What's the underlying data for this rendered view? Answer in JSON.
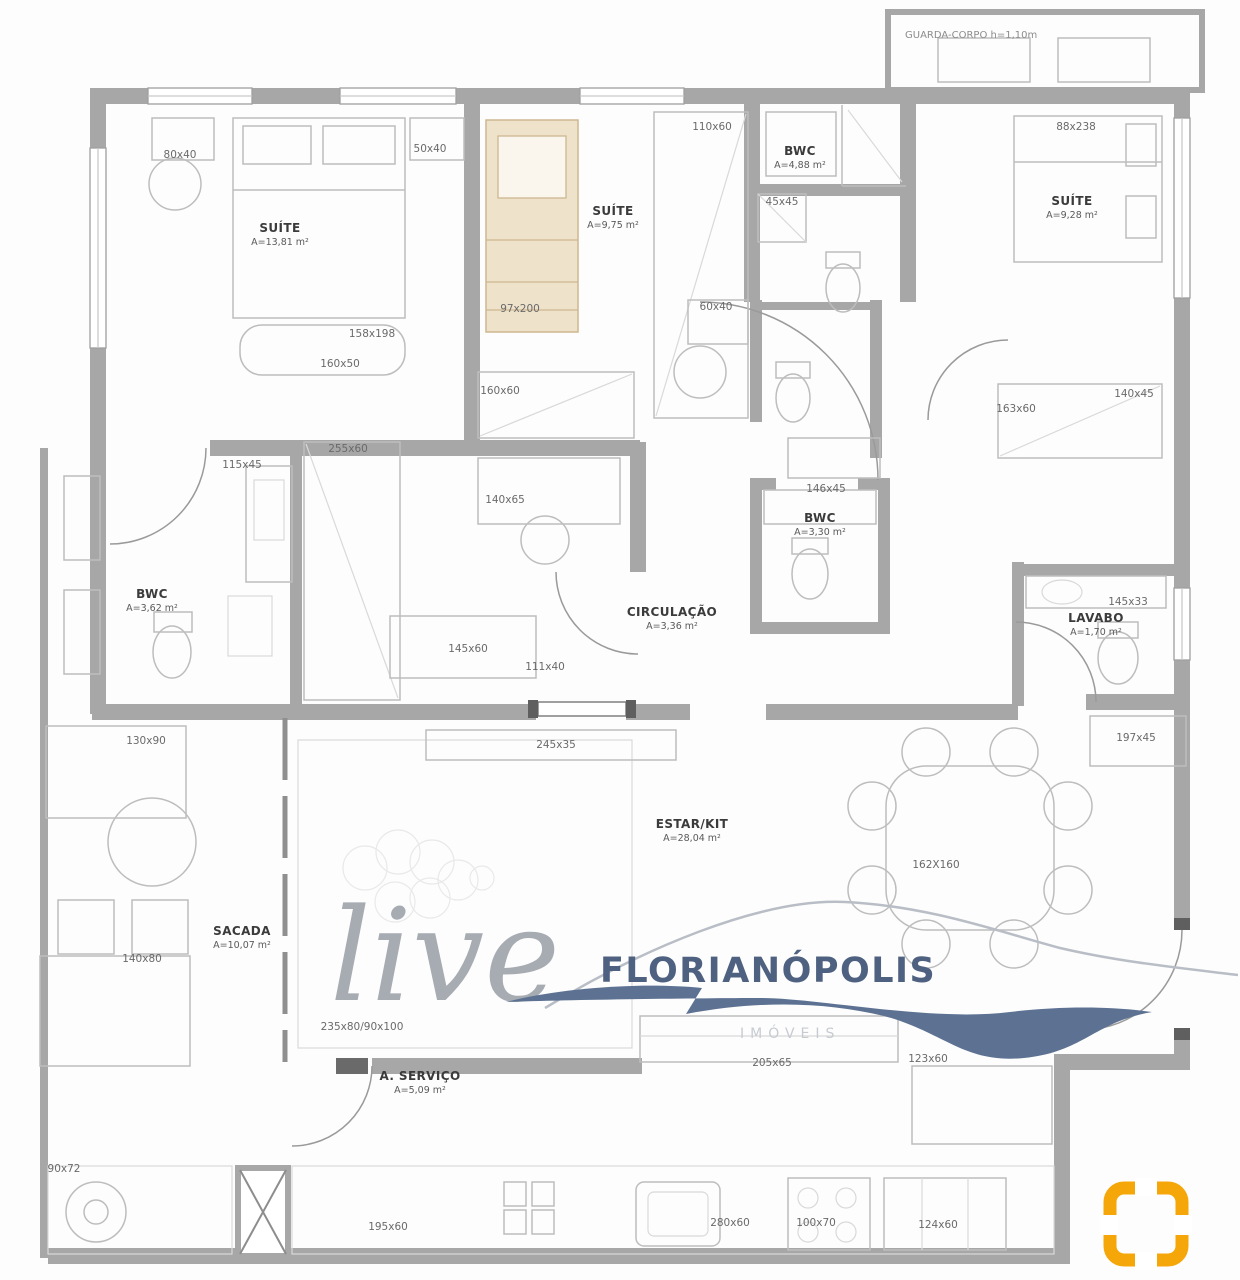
{
  "meta": {
    "type": "apartment-floor-plan"
  },
  "colors": {
    "wall": "#a7a7a7",
    "accent_yellow": "#f5a70a",
    "logo_blue": "#4f6180",
    "logo_gray": "#a0a5ac",
    "bed_tan": "#efe2cb"
  },
  "watermark": {
    "script_word": "live",
    "brand_name": "FLORIANÓPOLIS",
    "brand_subtitle": "IMÓVEIS"
  },
  "balcony": {
    "label": "GUARDA-CORPO h=1,10m"
  },
  "rooms": [
    {
      "name": "SUÍTE",
      "area": "A=13,81 m²",
      "x": 280,
      "y": 232
    },
    {
      "name": "SUÍTE",
      "area": "A=9,75 m²",
      "x": 613,
      "y": 215
    },
    {
      "name": "BWC",
      "area": "A=4,88 m²",
      "x": 800,
      "y": 155
    },
    {
      "name": "SUÍTE",
      "area": "A=9,28 m²",
      "x": 1072,
      "y": 205
    },
    {
      "name": "BWC",
      "area": "A=3,62 m²",
      "x": 152,
      "y": 598
    },
    {
      "name": "BWC",
      "area": "A=3,30 m²",
      "x": 820,
      "y": 522
    },
    {
      "name": "CIRCULAÇÃO",
      "area": "A=3,36 m²",
      "x": 672,
      "y": 616
    },
    {
      "name": "LAVABO",
      "area": "A=1,70 m²",
      "x": 1096,
      "y": 622
    },
    {
      "name": "ESTAR/KIT",
      "area": "A=28,04 m²",
      "x": 692,
      "y": 828
    },
    {
      "name": "SACADA",
      "area": "A=10,07 m²",
      "x": 242,
      "y": 935
    },
    {
      "name": "A. SERVIÇO",
      "area": "A=5,09 m²",
      "x": 420,
      "y": 1080
    }
  ],
  "dimensions": [
    {
      "label": "80x40",
      "x": 180,
      "y": 158
    },
    {
      "label": "50x40",
      "x": 430,
      "y": 152
    },
    {
      "label": "110x60",
      "x": 712,
      "y": 130
    },
    {
      "label": "88x238",
      "x": 1076,
      "y": 130
    },
    {
      "label": "45x45",
      "x": 782,
      "y": 205
    },
    {
      "label": "97x200",
      "x": 520,
      "y": 312
    },
    {
      "label": "60x40",
      "x": 716,
      "y": 310
    },
    {
      "label": "158x198",
      "x": 372,
      "y": 337
    },
    {
      "label": "160x50",
      "x": 340,
      "y": 367
    },
    {
      "label": "140x45",
      "x": 1134,
      "y": 397
    },
    {
      "label": "163x60",
      "x": 1016,
      "y": 412
    },
    {
      "label": "160x60",
      "x": 500,
      "y": 394
    },
    {
      "label": "255x60",
      "x": 348,
      "y": 452
    },
    {
      "label": "115x45",
      "x": 242,
      "y": 468
    },
    {
      "label": "140x65",
      "x": 505,
      "y": 503
    },
    {
      "label": "146x45",
      "x": 826,
      "y": 492
    },
    {
      "label": "145x33",
      "x": 1128,
      "y": 605
    },
    {
      "label": "145x60",
      "x": 468,
      "y": 652
    },
    {
      "label": "111x40",
      "x": 545,
      "y": 670
    },
    {
      "label": "130x90",
      "x": 146,
      "y": 744
    },
    {
      "label": "245x35",
      "x": 556,
      "y": 748
    },
    {
      "label": "197x45",
      "x": 1136,
      "y": 741
    },
    {
      "label": "162X160",
      "x": 936,
      "y": 868
    },
    {
      "label": "140x80",
      "x": 142,
      "y": 962
    },
    {
      "label": "235x80/90x100",
      "x": 362,
      "y": 1030
    },
    {
      "label": "205x65",
      "x": 772,
      "y": 1066
    },
    {
      "label": "123x60",
      "x": 928,
      "y": 1062
    },
    {
      "label": "90x72",
      "x": 64,
      "y": 1172
    },
    {
      "label": "195x60",
      "x": 388,
      "y": 1230
    },
    {
      "label": "280x60",
      "x": 730,
      "y": 1226
    },
    {
      "label": "100x70",
      "x": 816,
      "y": 1226
    },
    {
      "label": "124x60",
      "x": 938,
      "y": 1228
    }
  ]
}
